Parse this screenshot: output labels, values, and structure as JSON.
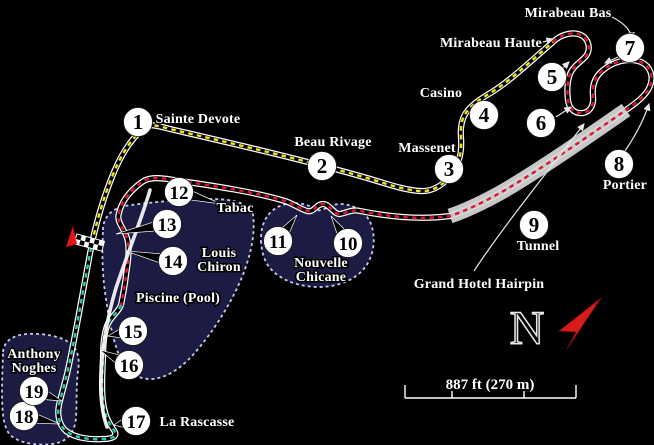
{
  "map": {
    "corners": [
      {
        "n": "1",
        "x": 138,
        "y": 122
      },
      {
        "n": "2",
        "x": 322,
        "y": 166
      },
      {
        "n": "3",
        "x": 449,
        "y": 169
      },
      {
        "n": "4",
        "x": 484,
        "y": 115
      },
      {
        "n": "5",
        "x": 552,
        "y": 77
      },
      {
        "n": "6",
        "x": 541,
        "y": 123
      },
      {
        "n": "7",
        "x": 630,
        "y": 48
      },
      {
        "n": "8",
        "x": 619,
        "y": 164
      },
      {
        "n": "9",
        "x": 534,
        "y": 225
      },
      {
        "n": "10",
        "x": 348,
        "y": 243,
        "px": 331,
        "py": 216
      },
      {
        "n": "11",
        "x": 278,
        "y": 241,
        "px": 297,
        "py": 215
      },
      {
        "n": "12",
        "x": 179,
        "y": 192,
        "px": 221,
        "py": 204
      },
      {
        "n": "13",
        "x": 167,
        "y": 224,
        "px": 116,
        "py": 234
      },
      {
        "n": "14",
        "x": 173,
        "y": 261,
        "px": 126,
        "py": 251
      },
      {
        "n": "15",
        "x": 133,
        "y": 331,
        "px": 108,
        "py": 336
      },
      {
        "n": "16",
        "x": 129,
        "y": 365,
        "px": 100,
        "py": 350
      },
      {
        "n": "17",
        "x": 136,
        "y": 421,
        "px": 114,
        "py": 425
      },
      {
        "n": "18",
        "x": 24,
        "y": 416,
        "px": 60,
        "py": 424
      },
      {
        "n": "19",
        "x": 34,
        "y": 391,
        "px": 62,
        "py": 401
      }
    ],
    "labels": [
      {
        "id": "sainte-devote",
        "lines": [
          "Sainte Devote"
        ],
        "x": 198,
        "y": 123
      },
      {
        "id": "beau-rivage",
        "lines": [
          "Beau Rivage"
        ],
        "x": 333,
        "y": 146
      },
      {
        "id": "massenet",
        "lines": [
          "Massenet"
        ],
        "x": 427,
        "y": 152
      },
      {
        "id": "casino",
        "lines": [
          "Casino"
        ],
        "x": 441,
        "y": 97
      },
      {
        "id": "mirabeau-haute",
        "lines": [
          "Mirabeau Haute"
        ],
        "x": 491,
        "y": 47
      },
      {
        "id": "mirabeau-bas",
        "lines": [
          "Mirabeau Bas"
        ],
        "x": 568,
        "y": 17
      },
      {
        "id": "portier",
        "lines": [
          "Portier"
        ],
        "x": 625,
        "y": 189
      },
      {
        "id": "tunnel",
        "lines": [
          "Tunnel"
        ],
        "x": 538,
        "y": 250
      },
      {
        "id": "grand-hotel-hairpin",
        "lines": [
          "Grand Hotel Hairpin"
        ],
        "x": 479,
        "y": 288
      },
      {
        "id": "nouvelle-chicane",
        "lines": [
          "Nouvelle",
          "Chicane"
        ],
        "x": 321,
        "y": 267
      },
      {
        "id": "tabac",
        "lines": [
          "Tabac"
        ],
        "x": 235,
        "y": 212
      },
      {
        "id": "louis-chiron",
        "lines": [
          "Louis",
          "Chiron"
        ],
        "x": 219,
        "y": 257
      },
      {
        "id": "piscine",
        "lines": [
          "Piscine (Pool)"
        ],
        "x": 178,
        "y": 302
      },
      {
        "id": "anthony-noghes",
        "lines": [
          "Anthony",
          "Noghes"
        ],
        "x": 34,
        "y": 358
      },
      {
        "id": "la-rascasse",
        "lines": [
          "La Rascasse"
        ],
        "x": 197,
        "y": 426
      }
    ],
    "compass": {
      "letter": "N"
    },
    "scale_bar": {
      "label": "887 ft (270 m)"
    },
    "colors": {
      "background": "#000000",
      "sector1_dash": "#ede31e",
      "sector2_dash": "#e0142d",
      "sector3_dash": "#2cc9ad",
      "track_edge": "#ffffff",
      "track_core": "#000000",
      "tunnel_band": "#d8d8d8",
      "zone_fill": "#1b1b44",
      "zone_border": "#c9c9ec",
      "marker_fill": "#ffffff",
      "marker_number": "#000000",
      "label_fill": "#ffffff",
      "compass_needle": "#d81c1c",
      "start_arrow": "#e01616",
      "pit_lane": "#ffffff"
    }
  }
}
